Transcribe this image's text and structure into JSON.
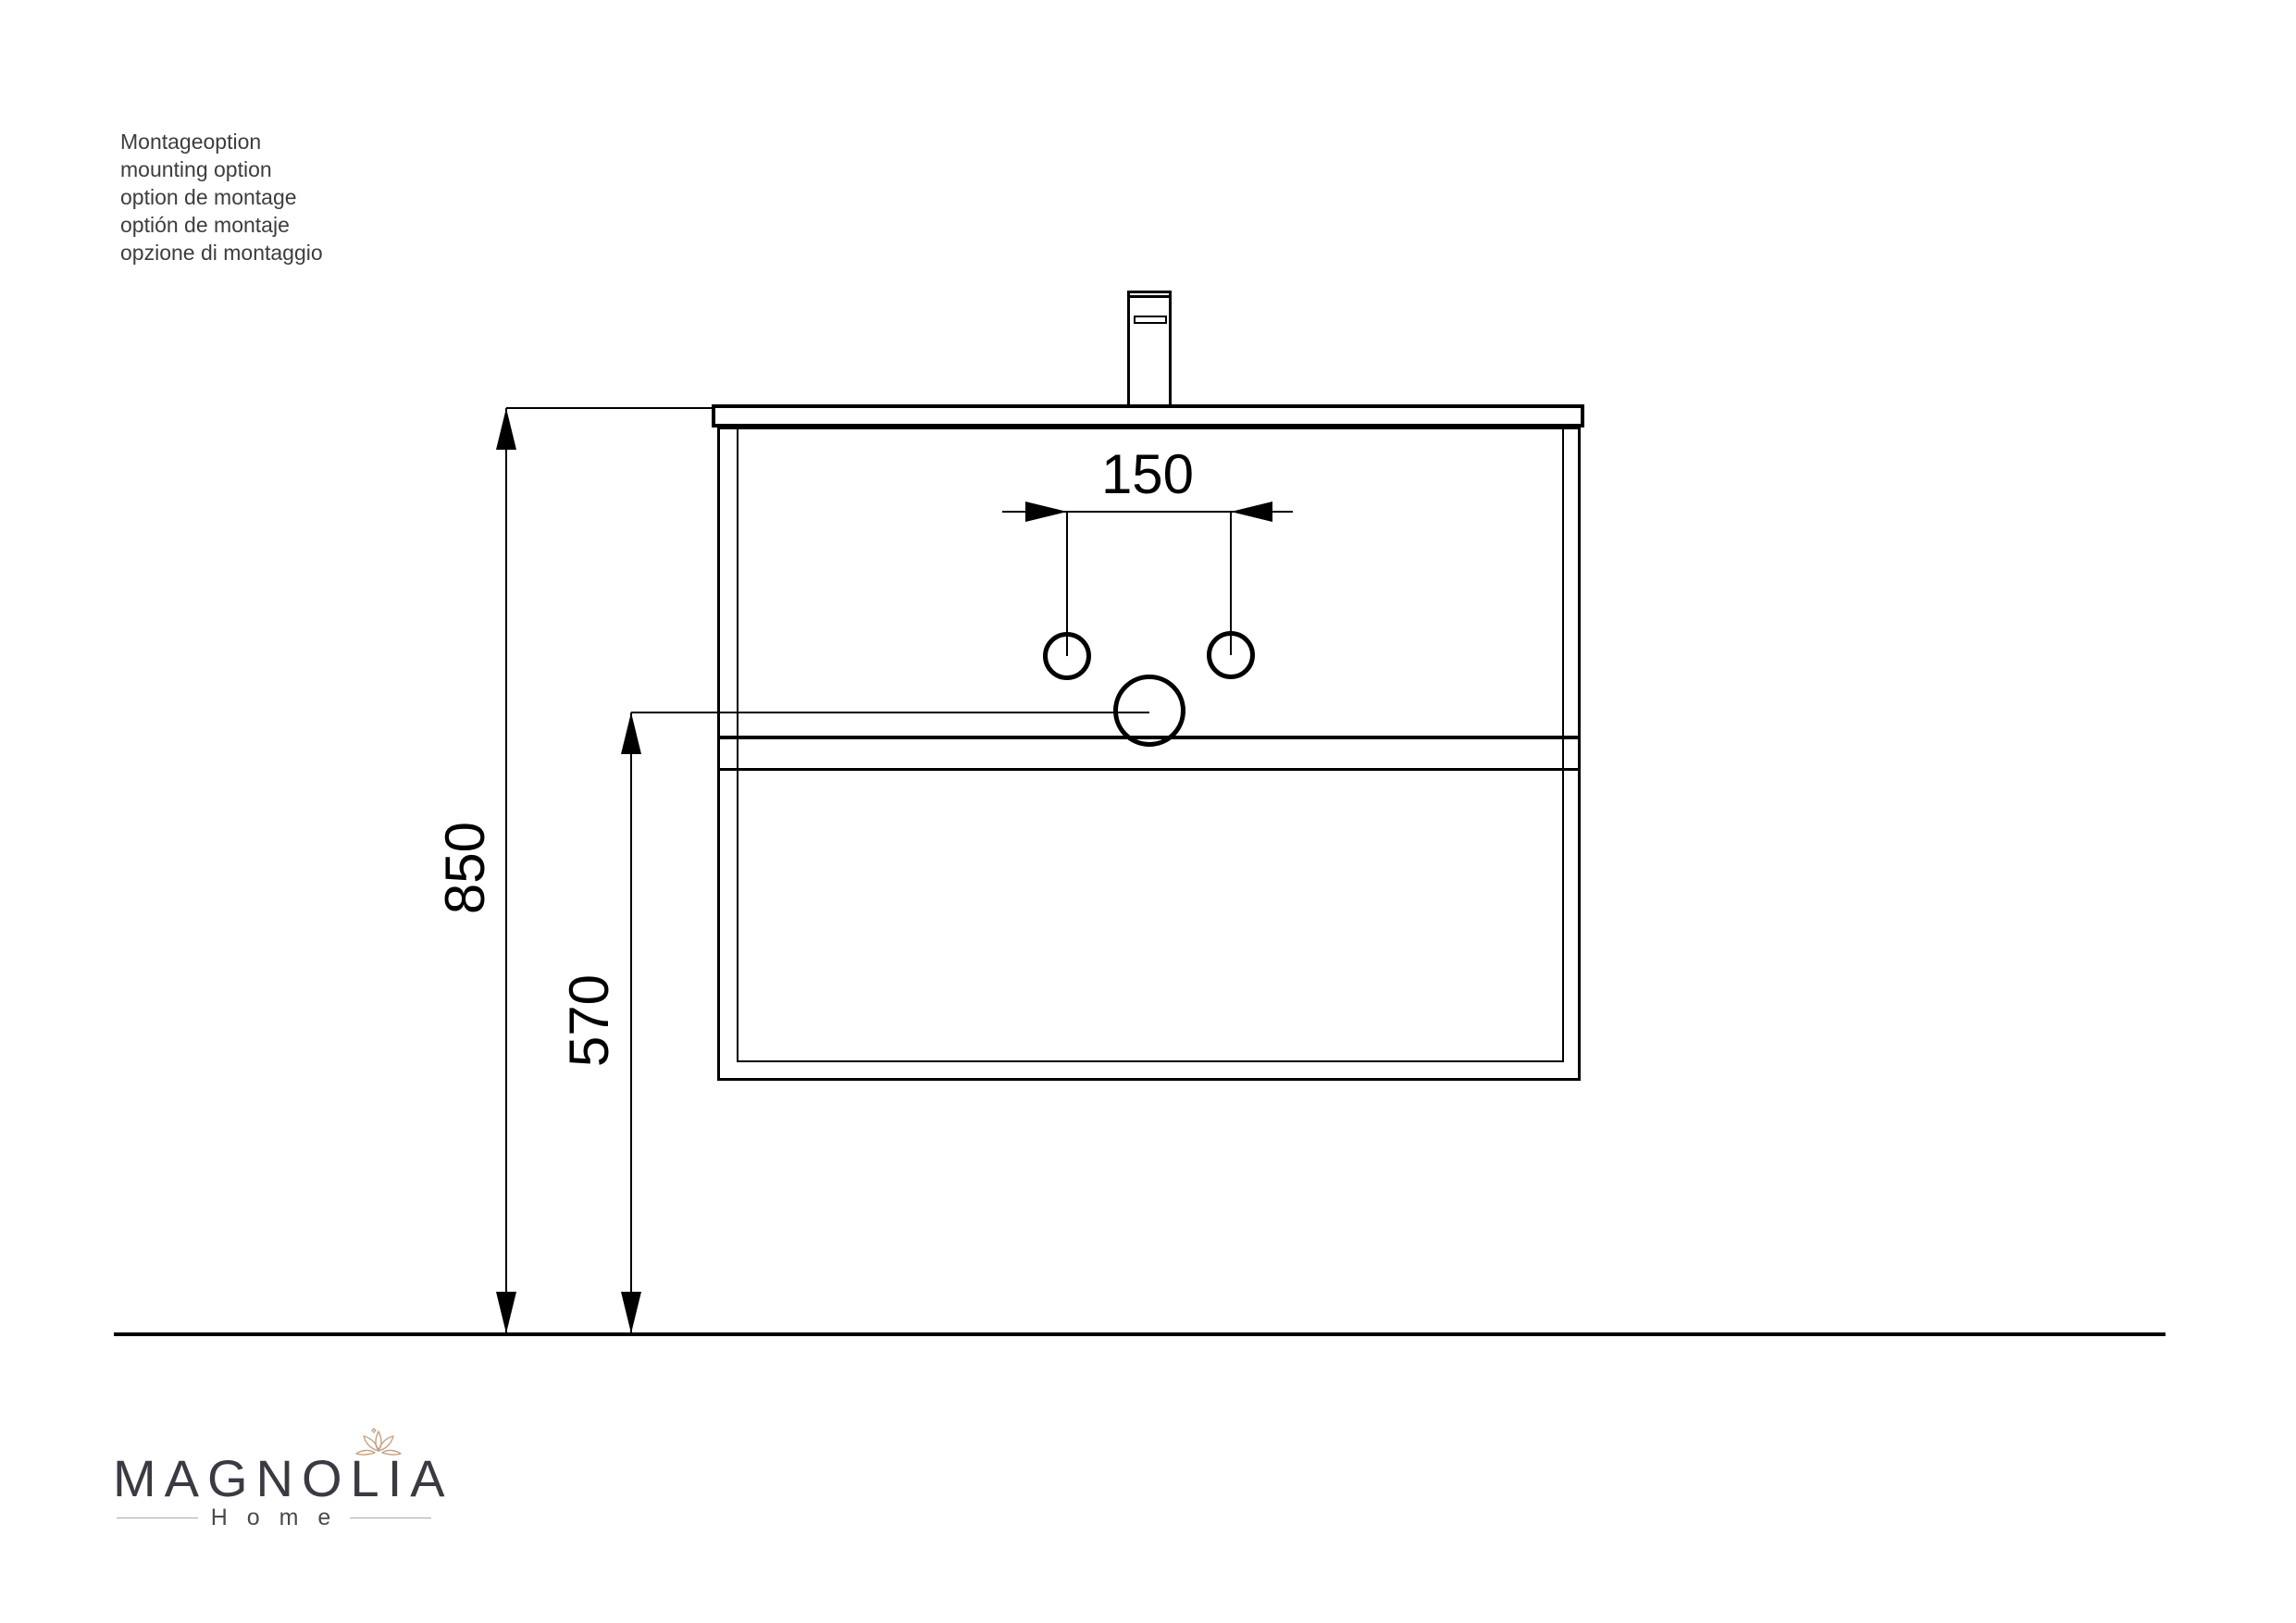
{
  "notes": {
    "lines": [
      "Montageoption",
      "mounting option",
      "option de montage",
      "optión de montaje",
      "opzione di montaggio"
    ]
  },
  "dimensions": {
    "faucet_hole_spacing": "150",
    "total_height": "850",
    "drain_height": "570"
  },
  "logo": {
    "brand": "MAGNOLIA",
    "subtitle": "H o m e"
  },
  "colors": {
    "line": "#000000",
    "note_text": "#3d3d3d",
    "logo_text": "#3a3a42",
    "logo_sub": "#4a4a4a",
    "flower": "#c3a184",
    "logo_rule": "#a9a9a9"
  }
}
